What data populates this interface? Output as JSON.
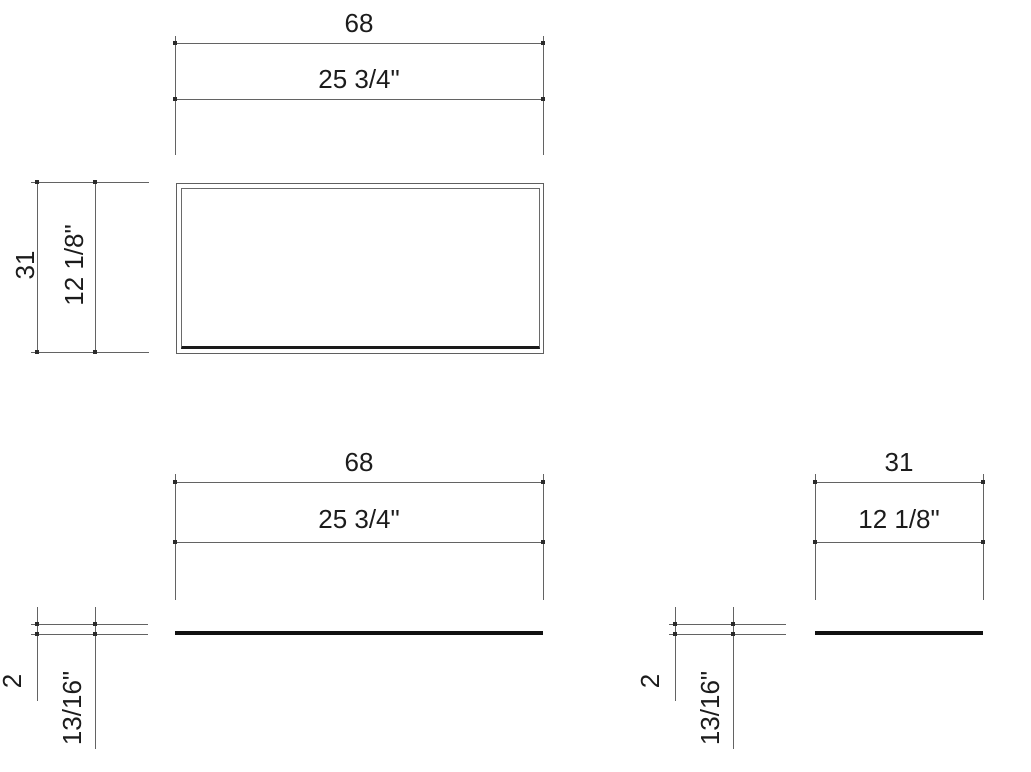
{
  "drawing": {
    "title": "panel-dimension-drawing",
    "units": {
      "primary": "cm",
      "secondary": "inches"
    },
    "views": {
      "top": {
        "width_cm": "68",
        "width_in": "25 3/4\"",
        "depth_cm": "31",
        "depth_in": "12 1/8\""
      },
      "front": {
        "width_cm": "68",
        "width_in": "25 3/4\"",
        "thickness_cm": "2",
        "thickness_in": "13/16\""
      },
      "side": {
        "depth_cm": "31",
        "depth_in": "12 1/8\"",
        "thickness_cm": "2",
        "thickness_in": "13/16\""
      }
    },
    "colors": {
      "background": "#ffffff",
      "thin_line": "#636363",
      "thick_line": "#111111",
      "text": "#1c1c1c"
    }
  }
}
